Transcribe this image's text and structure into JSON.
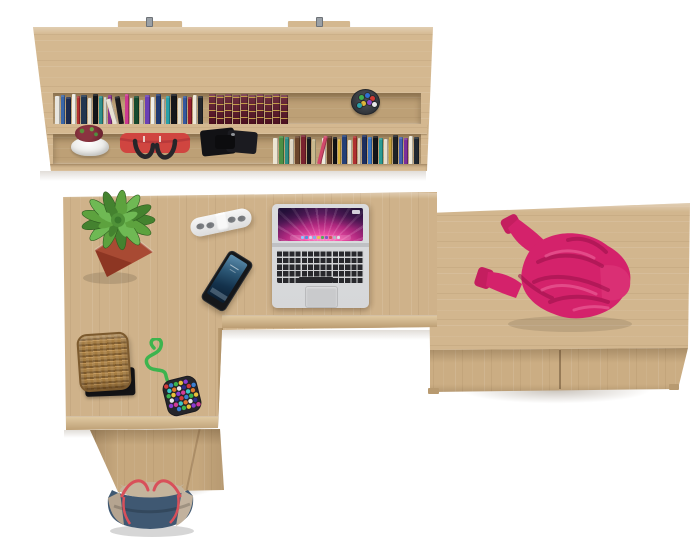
{
  "cssvars": {
    "--bg": "#ffffff",
    "--wood": "#cfb28a",
    "--wood-band": "#d4b890",
    "--wood-recess": "#bda076",
    "--wood-edge-light": "#dfc8a0",
    "--wood-edge-dark": "#bb9d73",
    "--wood-pedestal": "#c6a87e",
    "--wood-drawer-top": "#d2b68e",
    "--wood-drawer-front": "#cbad83",
    "--grain-light": "rgba(255,255,255,0.10)",
    "--grain-dark": "rgba(123,92,55,0.10)",
    "--shadow": "rgba(90,68,40,0.18)",
    "--seam": "rgba(70,45,20,0.40)",
    "--cup": "#2e3237",
    "--laptop-bezel": "#dadbdd",
    "--laptop-body": "#d6d7d9",
    "--laptop-deck": "#d2d3d5",
    "--key": "#28282c",
    "--trackpad": "#c9cacc",
    "--hinge": "#bfc0c3",
    "--aurora-pink": "#f454aa",
    "--aurora-mag": "#b0287f",
    "--aurora-deep": "#2b1742",
    "--phone-body": "#15171a",
    "--screen-blue-top": "#5d8eae",
    "--screen-blue-mid": "#2b5674",
    "--screen-blue-deep": "#0a1c2e",
    "--socket": "#85888c",
    "--pot-red": "#a84a33",
    "--tray": "#141417",
    "--basket-rim": "#7c5a2e",
    "--weave-dark": "#7d5a2c",
    "--weave-mid": "#a47c42",
    "--weave-light": "#c09455",
    "--cord": "#3db44e",
    "--pouch": "#26262b",
    "--sweater": "#d4226b",
    "--sweater-deep": "#99104a",
    "--sweater-bright": "#da2f74",
    "--sweater-cuff": "#c41e5f",
    "--sweater-high": "#f272a6",
    "--tote-navy": "#3f5872",
    "--tote-left": "#b5a490",
    "--tote-right": "#c2b29e",
    "--tote-interior": "#c4b49c",
    "--tote-strap": "#d8505a",
    "--redbag": "#d04540",
    "--redbag-flap": "#b8393a",
    "--redbag-handle": "#26262a",
    "--case": "#121215",
    "--case-lid": "#1b1b20"
  },
  "wall_shelf": {
    "row1_books": [
      {
        "c": "#e8e6df",
        "w": 5,
        "h": 28
      },
      {
        "c": "#3a66a8",
        "w": 4,
        "h": 29
      },
      {
        "c": "#1d2b4e",
        "w": 5,
        "h": 27
      },
      {
        "c": "#f0ede4",
        "w": 4,
        "h": 30
      },
      {
        "c": "#b33131",
        "w": 3,
        "h": 28
      },
      {
        "c": "#22364f",
        "w": 6,
        "h": 29
      },
      {
        "c": "#e2ddce",
        "w": 4,
        "h": 26
      },
      {
        "c": "#111418",
        "w": 5,
        "h": 30
      },
      {
        "c": "#2e8f8a",
        "w": 4,
        "h": 28
      },
      {
        "c": "#d8d5c9",
        "w": 3,
        "h": 27
      },
      {
        "c": "#8c2f8c",
        "w": 4,
        "h": 29
      },
      {
        "c": "#e8e2d4",
        "w": 5,
        "h": 26,
        "t": -16
      },
      {
        "c": "#1a1a1e",
        "w": 5,
        "h": 28,
        "t": -9
      },
      {
        "c": "#cf3a8f",
        "w": 4,
        "h": 30
      },
      {
        "c": "#efe9da",
        "w": 3,
        "h": 26
      },
      {
        "c": "#174a2e",
        "w": 5,
        "h": 28
      },
      {
        "c": "#c7c2b2",
        "w": 4,
        "h": 24
      },
      {
        "c": "#6a3fb5",
        "w": 5,
        "h": 29
      },
      {
        "c": "#efefe8",
        "w": 4,
        "h": 27
      },
      {
        "c": "#203a70",
        "w": 5,
        "h": 30
      },
      {
        "c": "#d0cfc8",
        "w": 3,
        "h": 25
      },
      {
        "c": "#2aa0a8",
        "w": 4,
        "h": 28
      },
      {
        "c": "#14161a",
        "w": 6,
        "h": 30
      },
      {
        "c": "#e0dbcc",
        "w": 4,
        "h": 26
      },
      {
        "c": "#35589e",
        "w": 4,
        "h": 28
      },
      {
        "c": "#991f2e",
        "w": 4,
        "h": 27
      },
      {
        "c": "#efe8d8",
        "w": 4,
        "h": 29
      },
      {
        "c": "#23262b",
        "w": 5,
        "h": 28
      },
      {
        "s": 4
      },
      {
        "c": "#5c1426",
        "w": 7,
        "h": 30,
        "classic": true
      },
      {
        "c": "#5c1426",
        "w": 7,
        "h": 29,
        "classic": true
      },
      {
        "c": "#5c1426",
        "w": 7,
        "h": 30,
        "classic": true
      },
      {
        "c": "#5c1426",
        "w": 7,
        "h": 29,
        "classic": true
      },
      {
        "c": "#5c1426",
        "w": 7,
        "h": 30,
        "classic": true
      },
      {
        "c": "#5c1426",
        "w": 7,
        "h": 29,
        "classic": true
      },
      {
        "c": "#5c1426",
        "w": 7,
        "h": 30,
        "classic": true
      },
      {
        "c": "#5c1426",
        "w": 7,
        "h": 29,
        "classic": true
      },
      {
        "c": "#5c1426",
        "w": 7,
        "h": 30,
        "classic": true
      },
      {
        "c": "#5c1426",
        "w": 7,
        "h": 29,
        "classic": true
      }
    ],
    "row2_books": [
      {
        "s": 217
      },
      {
        "c": "#ece5d2",
        "w": 5,
        "h": 26
      },
      {
        "c": "#4c8f45",
        "w": 5,
        "h": 28
      },
      {
        "c": "#2e8f85",
        "w": 4,
        "h": 27
      },
      {
        "c": "#dfd8c6",
        "w": 4,
        "h": 25
      },
      {
        "c": "#6b452c",
        "w": 5,
        "h": 28
      },
      {
        "c": "#7a222e",
        "w": 5,
        "h": 29
      },
      {
        "c": "#17191d",
        "w": 4,
        "h": 27
      },
      {
        "c": "#c8b98e",
        "w": 4,
        "h": 25
      },
      {
        "c": "#d2486b",
        "w": 4,
        "h": 29,
        "t": 14
      },
      {
        "c": "#efeadb",
        "w": 4,
        "h": 26
      },
      {
        "c": "#5d3a24",
        "w": 5,
        "h": 28
      },
      {
        "c": "#101114",
        "w": 4,
        "h": 27
      },
      {
        "c": "#d9b23a",
        "w": 3,
        "h": 25
      },
      {
        "c": "#243f77",
        "w": 5,
        "h": 29
      },
      {
        "c": "#e8e2d2",
        "w": 4,
        "h": 24
      },
      {
        "c": "#b03030",
        "w": 4,
        "h": 28
      },
      {
        "c": "#d5d0c0",
        "w": 3,
        "h": 26
      },
      {
        "c": "#1c2e5e",
        "w": 5,
        "h": 29
      },
      {
        "c": "#3a76c4",
        "w": 4,
        "h": 27
      },
      {
        "c": "#121418",
        "w": 5,
        "h": 28
      },
      {
        "c": "#2a9a92",
        "w": 4,
        "h": 26
      },
      {
        "c": "#e5dfcf",
        "w": 4,
        "h": 25
      },
      {
        "c": "#c8a23c",
        "w": 3,
        "h": 27
      },
      {
        "c": "#1e2126",
        "w": 5,
        "h": 29
      },
      {
        "c": "#4060b0",
        "w": 4,
        "h": 27
      },
      {
        "c": "#7d2f9a",
        "w": 4,
        "h": 26
      },
      {
        "c": "#efe9d9",
        "w": 4,
        "h": 28
      },
      {
        "c": "#202830",
        "w": 5,
        "h": 27
      }
    ],
    "pen_cup_pens": [
      {
        "x": 7,
        "y": 5,
        "c": "#3fae4e"
      },
      {
        "x": 13,
        "y": 3,
        "c": "#2f6fd0"
      },
      {
        "x": 18,
        "y": 6,
        "c": "#d03a32"
      },
      {
        "x": 9,
        "y": 11,
        "c": "#e0b73a"
      },
      {
        "x": 15,
        "y": 10,
        "c": "#8a46c8"
      },
      {
        "x": 20,
        "y": 12,
        "c": "#e8e8e8"
      },
      {
        "x": 5,
        "y": 13,
        "c": "#2aa0a8"
      }
    ]
  },
  "laptop": {
    "dock_icons": [
      "#8fc7ff",
      "#4f8fe0",
      "#c8daf0",
      "#7fb0e8",
      "#e8c050",
      "#58b058",
      "#7f58c8",
      "#d05858",
      "#b0b8c0",
      "#e0e0e8"
    ]
  },
  "plant": {
    "leaves": [
      "#44822f",
      "#5da23e",
      "#6fb954"
    ],
    "center": "#4f9238",
    "center_dark": "#3a7a2c"
  },
  "toy": {
    "beads": [
      "#d23c3c",
      "#3c7fd2",
      "#3cb44e",
      "#e8c23c",
      "#8a3cd2",
      "#d23c98",
      "#3cc8c8",
      "#e07a2e",
      "#e8e8e8",
      "#2c2c8a"
    ]
  }
}
